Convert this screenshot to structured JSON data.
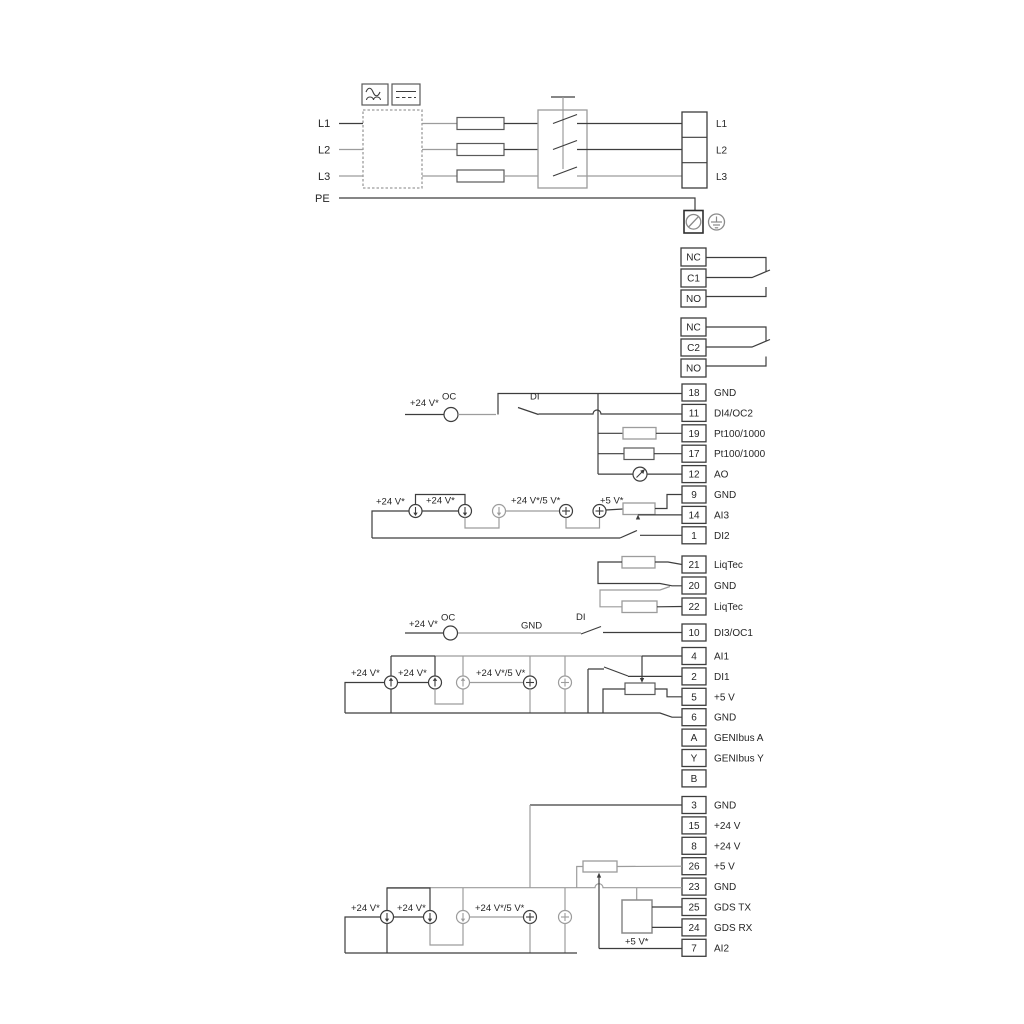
{
  "diagram": {
    "colors": {
      "line_dark": "#3d3d3d",
      "line_gray": "#9c9c9c"
    },
    "power": {
      "inputs": [
        "L1",
        "L2",
        "L3"
      ],
      "pe": "PE",
      "outputs": [
        "L1",
        "L2",
        "L3"
      ]
    },
    "relay1": {
      "t": [
        "NC",
        "C1",
        "NO"
      ]
    },
    "relay2": {
      "t": [
        "NC",
        "C2",
        "NO"
      ]
    },
    "strip1": [
      {
        "n": "18",
        "l": "GND"
      },
      {
        "n": "11",
        "l": "DI4/OC2"
      },
      {
        "n": "19",
        "l": "Pt100/1000"
      },
      {
        "n": "17",
        "l": "Pt100/1000"
      },
      {
        "n": "12",
        "l": "AO"
      },
      {
        "n": "9",
        "l": "GND"
      },
      {
        "n": "14",
        "l": "AI3"
      },
      {
        "n": "1",
        "l": "DI2"
      }
    ],
    "liqtec": [
      {
        "n": "21",
        "l": "LiqTec"
      },
      {
        "n": "20",
        "l": "GND"
      },
      {
        "n": "22",
        "l": "LiqTec"
      }
    ],
    "t10": {
      "n": "10",
      "l": "DI3/OC1"
    },
    "strip2": [
      {
        "n": "4",
        "l": "AI1"
      },
      {
        "n": "2",
        "l": "DI1"
      },
      {
        "n": "5",
        "l": "+5 V"
      },
      {
        "n": "6",
        "l": "GND"
      },
      {
        "n": "A",
        "l": "GENIbus A"
      },
      {
        "n": "Y",
        "l": "GENIbus Y"
      },
      {
        "n": "B",
        "l": "GENIbus B"
      }
    ],
    "strip3": [
      {
        "n": "3",
        "l": "GND"
      },
      {
        "n": "15",
        "l": "+24 V"
      },
      {
        "n": "8",
        "l": "+24 V"
      },
      {
        "n": "26",
        "l": "+5 V"
      },
      {
        "n": "23",
        "l": "GND"
      },
      {
        "n": "25",
        "l": "GDS TX"
      },
      {
        "n": "24",
        "l": "GDS RX"
      },
      {
        "n": "7",
        "l": "AI2"
      }
    ],
    "ann": {
      "p24": "+24 V*",
      "p245": "+24 V*/5 V*",
      "p5": "+5 V*",
      "oc": "OC",
      "di": "DI",
      "gnd": "GND"
    }
  }
}
